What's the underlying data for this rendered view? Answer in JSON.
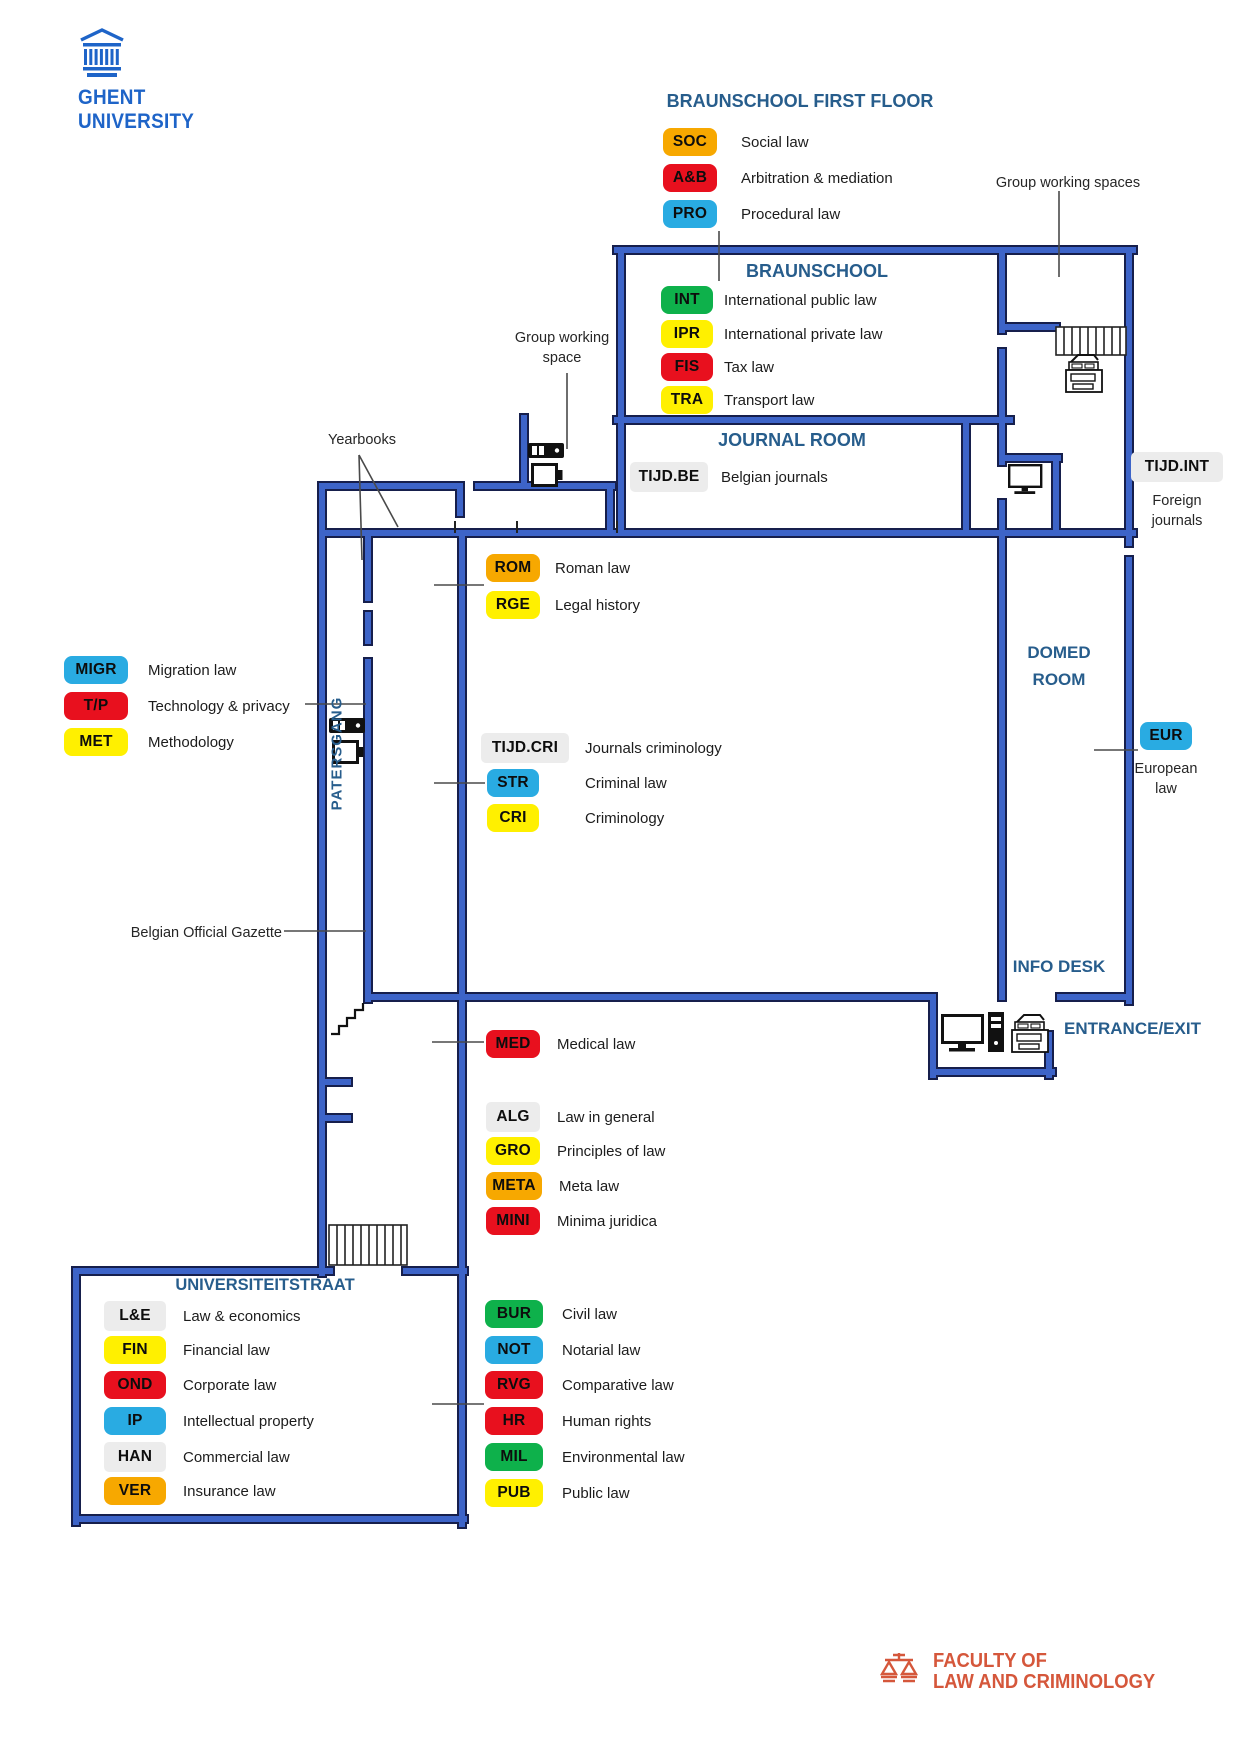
{
  "ghent_logo": {
    "line1": "GHENT",
    "line2": "UNIVERSITY"
  },
  "faculty_logo": {
    "line1": "FACULTY OF",
    "line2": "LAW AND CRIMINOLOGY"
  },
  "colors": {
    "amber": "#F7A800",
    "red": "#E8101E",
    "cyan": "#29ABE2",
    "green": "#0EB14B",
    "yellow": "#FFF000",
    "gray": "#ECECEC",
    "wall_fill": "#3D64C8",
    "wall_edge": "#161F4C",
    "room_title_blue": "#275D8C",
    "ghent_blue": "#1E64C8",
    "faculty_orange": "#D5573B"
  },
  "rooms": {
    "first_floor_title": "BRAUNSCHOOL FIRST FLOOR",
    "braunschool": "BRAUNSCHOOL",
    "journal_room": "JOURNAL ROOM",
    "domed_room_line1": "DOMED",
    "domed_room_line2": "ROOM",
    "info_desk": "INFO DESK",
    "entrance": "ENTRANCE/EXIT",
    "universiteitstraat": "UNIVERSITEITSTRAAT",
    "patersgang": "PATERSGANG"
  },
  "annotations": {
    "group_working_spaces": "Group working spaces",
    "group_working_space_line1": "Group working",
    "group_working_space_line2": "space",
    "yearbooks": "Yearbooks",
    "belgian_official_gazette": "Belgian Official Gazette",
    "foreign_journals_line1": "Foreign",
    "foreign_journals_line2": "journals",
    "european_law_line1": "European",
    "european_law_line2": "law"
  },
  "groups": {
    "first_floor": {
      "items": [
        {
          "code": "SOC",
          "label": "Social law",
          "color": "amber"
        },
        {
          "code": "A&B",
          "label": "Arbitration & mediation",
          "color": "red"
        },
        {
          "code": "PRO",
          "label": "Procedural law",
          "color": "cyan"
        }
      ]
    },
    "braunschool": {
      "items": [
        {
          "code": "INT",
          "label": "International public law",
          "color": "green"
        },
        {
          "code": "IPR",
          "label": "International private law",
          "color": "yellow"
        },
        {
          "code": "FIS",
          "label": "Tax law",
          "color": "red"
        },
        {
          "code": "TRA",
          "label": "Transport law",
          "color": "yellow"
        }
      ]
    },
    "journal": {
      "items": [
        {
          "code": "TIJD.BE",
          "label": "Belgian journals",
          "color": "gray"
        }
      ]
    },
    "tijd_int": {
      "code": "TIJD.INT",
      "color": "gray"
    },
    "roman": {
      "items": [
        {
          "code": "ROM",
          "label": "Roman law",
          "color": "amber"
        },
        {
          "code": "RGE",
          "label": "Legal history",
          "color": "yellow"
        }
      ]
    },
    "west": {
      "items": [
        {
          "code": "MIGR",
          "label": "Migration law",
          "color": "cyan"
        },
        {
          "code": "T/P",
          "label": "Technology & privacy",
          "color": "red"
        },
        {
          "code": "MET",
          "label": "Methodology",
          "color": "yellow"
        }
      ]
    },
    "criminology": {
      "items": [
        {
          "code": "TIJD.CRI",
          "label": "Journals criminology",
          "color": "gray"
        },
        {
          "code": "STR",
          "label": "Criminal law",
          "color": "cyan"
        },
        {
          "code": "CRI",
          "label": "Criminology",
          "color": "yellow"
        }
      ]
    },
    "eur": {
      "code": "EUR",
      "color": "cyan"
    },
    "medical": {
      "items": [
        {
          "code": "MED",
          "label": "Medical law",
          "color": "red"
        }
      ]
    },
    "general": {
      "items": [
        {
          "code": "ALG",
          "label": "Law in general",
          "color": "gray"
        },
        {
          "code": "GRO",
          "label": "Principles of law",
          "color": "yellow"
        },
        {
          "code": "META",
          "label": "Meta law",
          "color": "amber"
        },
        {
          "code": "MINI",
          "label": "Minima juridica",
          "color": "red"
        }
      ]
    },
    "universiteitstraat": {
      "items": [
        {
          "code": "L&E",
          "label": "Law & economics",
          "color": "gray"
        },
        {
          "code": "FIN",
          "label": "Financial law",
          "color": "yellow"
        },
        {
          "code": "OND",
          "label": "Corporate law",
          "color": "red"
        },
        {
          "code": "IP",
          "label": "Intellectual property",
          "color": "cyan"
        },
        {
          "code": "HAN",
          "label": "Commercial law",
          "color": "gray"
        },
        {
          "code": "VER",
          "label": "Insurance law",
          "color": "amber"
        }
      ]
    },
    "southeast": {
      "items": [
        {
          "code": "BUR",
          "label": "Civil law",
          "color": "green"
        },
        {
          "code": "NOT",
          "label": "Notarial law",
          "color": "cyan"
        },
        {
          "code": "RVG",
          "label": "Comparative law",
          "color": "red"
        },
        {
          "code": "HR",
          "label": "Human rights",
          "color": "red"
        },
        {
          "code": "MIL",
          "label": "Environmental law",
          "color": "green"
        },
        {
          "code": "PUB",
          "label": "Public law",
          "color": "yellow"
        }
      ]
    }
  }
}
